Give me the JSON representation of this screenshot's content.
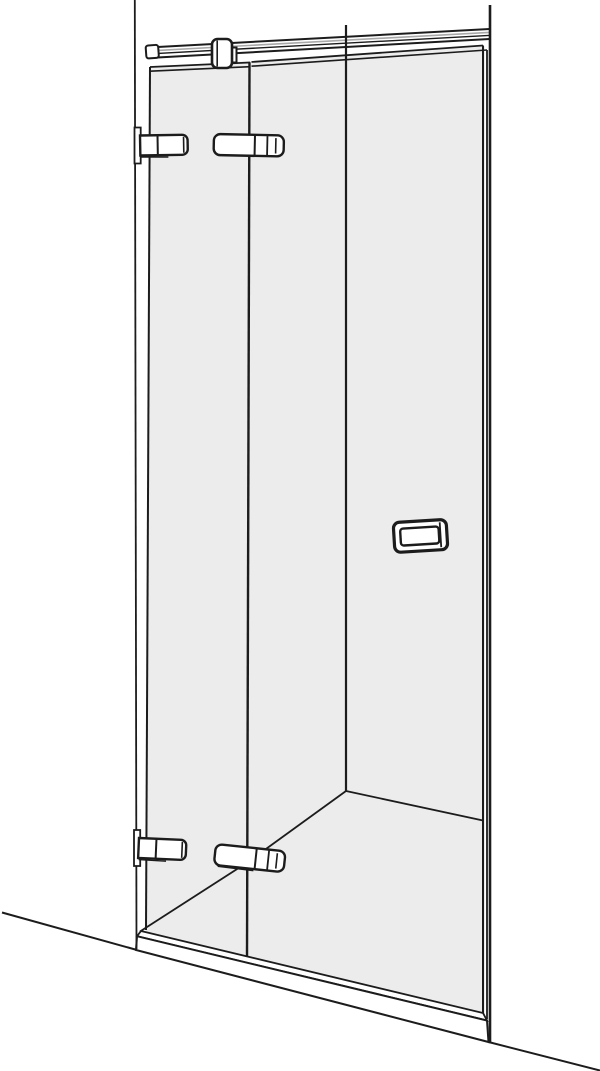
{
  "meta": {
    "description": "Technical line drawing of a folding hinged glass shower door installed in a niche, perspective view",
    "visible_text": ""
  },
  "palette": {
    "line": "#1c1c1c",
    "glass": "#ececec",
    "bar_highlight": "#a8a8a8",
    "white": "#ffffff"
  },
  "drawing": {
    "viewbox": "0 0 600 1071",
    "paths": {
      "wall_left": "M134.8,0 L136.5,949",
      "wall_right": "M490,5 L490,1042",
      "floor_left": "M2,912.5 L137,950",
      "floor_right": "M488.5,1042 L600,1070.5",
      "glass_panel": "M150,67 L485,46.5 L485,1015 L146,931.5 Z",
      "glass_edge_left": "M150,67 L146,930",
      "glass_divider": "M249.5,62.3 L247,956",
      "glass_edge_right_inner": "M483,45.5 L483,1013",
      "glass_edge_right_outer": "M487,50 L487,1019",
      "glass_top_a_outer": "M150,67 L250,62.5",
      "glass_top_a_inner": "M150,71.2 L250,66.7",
      "glass_top_b_outer": "M251.5,62 L483,45.5",
      "glass_top_b_inner": "M251.5,66.2 L487,50",
      "corner_line": "M346,25 L346,791",
      "floor_junction_left": "M346,791 L248,862 L140,931.5",
      "floor_junction_right": "M346,791 L483,820.5",
      "sill_top": "M141,931 L483,1013 L487,1020.5 L137,936.2 Z",
      "sill_front": "M137,936.2 L487,1020.5 L488.5,1042 L136,950 Z",
      "bar_band": "M158,47 L489,29 L489,39 L158,57.5 Z",
      "bar_top": "M157.5,47 L489.5,29",
      "bar_highlight": "M158,50.4 L489,32.4",
      "bar_mid": "M158,53.4 L489,35.4",
      "bar_bottom": "M157.5,57.5 L489.5,39",
      "bar_end_cap": "M148.5,45.2 h7.5 a2.5,2.5 0 0 1 2.5,2.5 v8 a2.5,2.5 0 0 1 -2.5,2.5 h-7.5 a2.5,2.5 0 0 1 -2.5,-2.5 v-8 a2.5,2.5 0 0 1 2.5,-2.5 Z",
      "clamp_tab": "M228.5,47.5 h8 v15 h-8 Z",
      "clamp_body": "M217.5,39 h9 a5.5,5.5 0 0 1 5.5,5.5 v18 a5.5,5.5 0 0 1 -5.5,5.5 h-9 a5.5,5.5 0 0 1 -5.5,-5.5 v-18 a5.5,5.5 0 0 1 5.5,-5.5 Z",
      "clamp_inner": "M217.2,40.5 L217.2,66.5",
      "hinge_plate": "M0,0 h6.2 v36 h-6.2 Z",
      "hinge_body_small": "M0,0 h42 a5.5,5.5 0 0 1 5.5,5.5 v9 a5.5,5.5 0 0 1 -5.5,5.5 h-42 Z",
      "hinge_small_seg": "M17.5,0.3 L17.5,19.7",
      "hinge_small_face": "M43.5,2 L43.5,18",
      "hinge_small_shadow": "M0.5,21.6 L28,22",
      "hinge_body_large": "M6.5,0 h57 a6.5,6.5 0 0 1 6.5,6.5 v8 a6.5,6.5 0 0 1 -6.5,6.5 h-57 a6.5,6.5 0 0 1 -6.5,-6.5 v-8 a6.5,6.5 0 0 1 6.5,-6.5 Z",
      "hinge_large_seg1": "M41,0.4 L41,20.6",
      "hinge_large_seg2": "M53.5,1 L53.5,20",
      "hinge_large_face": "M62,2.8 L62,18.2",
      "hinge_large_shadow": "M4,22 L40,22.6",
      "handle_outer": "M400,521 h41 a6,6 0 0 1 6,6 v18 a6,6 0 0 1 -6,6 h-41 a6,6 0 0 1 -6,-6 v-18 a6,6 0 0 1 6,-6 Z",
      "handle_inner": "M403.5,527.5 h32.5 a3,3 0 0 1 3,3 v11 a3,3 0 0 1 -3,3 h-32.5 a3,3 0 0 1 -3,-3 v-11 a3,3 0 0 1 3,-3 Z",
      "handle_end": "M440.5,523.5 L440.5,548.5"
    }
  }
}
